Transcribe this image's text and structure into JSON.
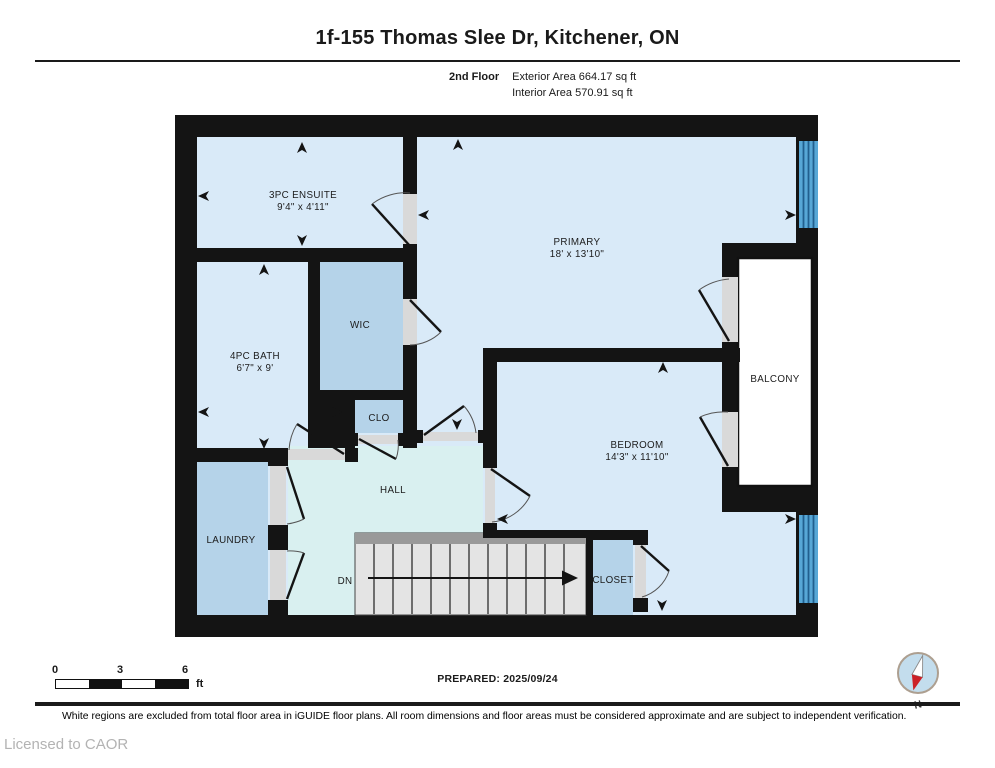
{
  "header": {
    "title": "1f-155 Thomas Slee Dr, Kitchener, ON",
    "floor_label": "2nd Floor",
    "exterior_area": "Exterior Area 664.17 sq ft",
    "interior_area": "Interior Area 570.91 sq ft"
  },
  "plan": {
    "rooms": {
      "ensuite": {
        "name": "3PC ENSUITE",
        "dims": "9'4\" x 4'11\""
      },
      "primary": {
        "name": "PRIMARY",
        "dims": "18' x 13'10\""
      },
      "wic": {
        "name": "WIC"
      },
      "bath": {
        "name": "4PC BATH",
        "dims": "6'7\" x 9'"
      },
      "clo": {
        "name": "CLO"
      },
      "hall": {
        "name": "HALL"
      },
      "laundry": {
        "name": "LAUNDRY"
      },
      "bedroom": {
        "name": "BEDROOM",
        "dims": "14'3\" x 11'10\""
      },
      "closet": {
        "name": "CLOSET"
      },
      "balcony": {
        "name": "BALCONY"
      }
    },
    "stairs_label": "DN"
  },
  "scale_bar": {
    "ticks": [
      "0",
      "3",
      "6"
    ],
    "unit": "ft"
  },
  "prepared_label": "PREPARED: 2025/09/24",
  "compass": {
    "north_label": "N"
  },
  "footer": {
    "disclaimer": "White regions are excluded from total floor area in iGUIDE floor plans. All room dimensions and floor areas must be considered approximate and are subject to independent verification.",
    "license": "Licensed to CAOR"
  },
  "colors": {
    "wall": "#141414",
    "room_light": "#d9eaf8",
    "room_medium": "#b5d3e9",
    "hall": "#d9f0f0",
    "stairs": "#e4e4e4",
    "stairs_band": "#999999",
    "window_band": "#57a7d6",
    "window_stripe": "#215f8e",
    "door_sill": "#d9d9d9",
    "balcony_fill": "#ffffff"
  }
}
